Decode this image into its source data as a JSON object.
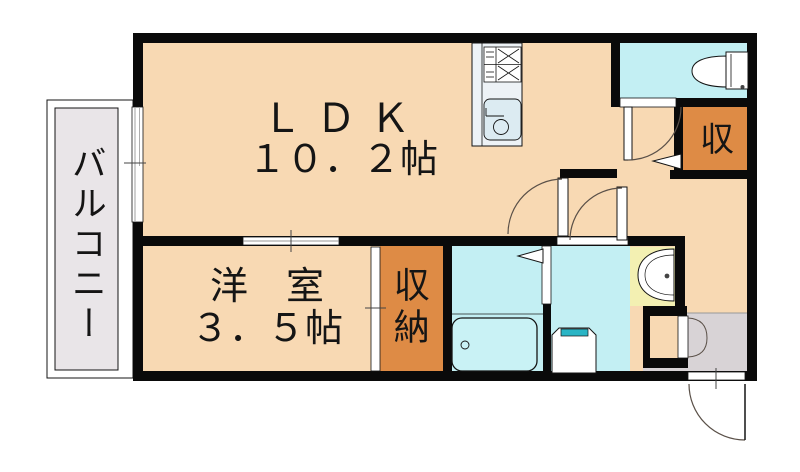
{
  "floorplan": {
    "labels": {
      "ldk_line1": "ＬＤＫ",
      "ldk_line2": "１０．２帖",
      "western_line1": "洋　室",
      "western_line2": "３．５帖",
      "closet": "収納",
      "storage_small": "収",
      "balcony": "バルコニー"
    },
    "colors": {
      "floor": "#f8d9b3",
      "wet": "#c3eff3",
      "storage": "#de8b45",
      "vanity": "#f3f0b2",
      "entrance": "#d8d3d6",
      "balcony": "#e9e5e8",
      "wall": "#0a0a0a",
      "counter": "#edf2f6",
      "sink": "#dcebf2",
      "tub": "#c9f2f5",
      "washer_accent": "#2ab5c5",
      "door_arc": "#5a5048"
    }
  }
}
